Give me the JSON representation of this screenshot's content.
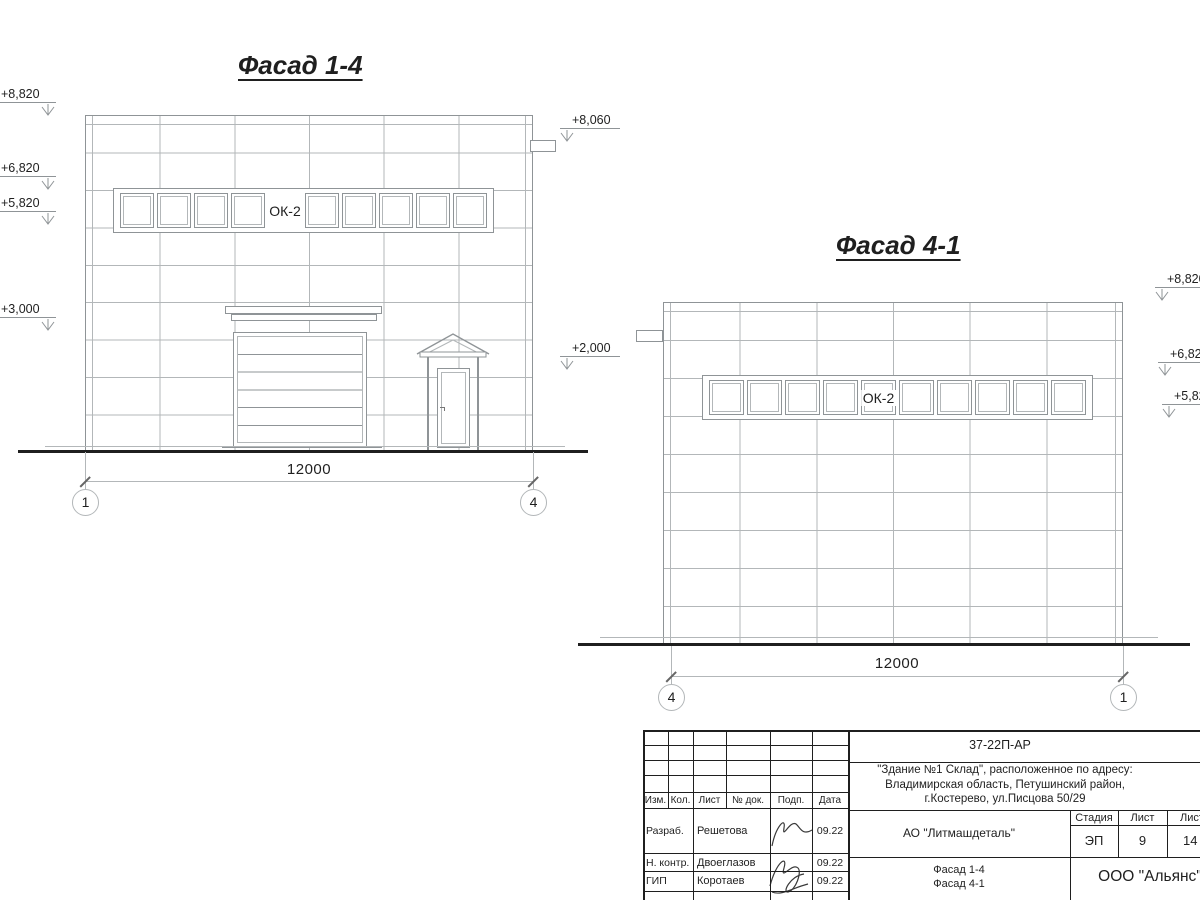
{
  "colors": {
    "grid_line": "#b3b7b9",
    "outline": "#8f9497",
    "ink": "#1f1f1f"
  },
  "facade14": {
    "title": "Фасад 1-4",
    "window_label": "ОК-2",
    "windows_count": 10,
    "label_cell": 5,
    "label_cell_framed": false,
    "dimension": "12000",
    "axis_left": "1",
    "axis_right": "4",
    "elevations_left": [
      {
        "label": "+8,820"
      },
      {
        "label": "+6,820"
      },
      {
        "label": "+5,820"
      },
      {
        "label": "+3,000"
      }
    ],
    "elevations_right": [
      {
        "label": "+8,060"
      },
      {
        "label": "+2,000"
      }
    ]
  },
  "facade41": {
    "title": "Фасад 4-1",
    "window_label": "ОК-2",
    "windows_count": 10,
    "label_cell": 5,
    "label_cell_framed": true,
    "dimension": "12000",
    "axis_left": "4",
    "axis_right": "1",
    "elevations_right": [
      {
        "label": "+8,820"
      },
      {
        "label": "+6,820"
      },
      {
        "label": "+5,820"
      }
    ]
  },
  "titleblock": {
    "doc_number": "37-22П-АР",
    "object_address": {
      "line1": "\"Здание №1 Склад\", расположенное по адресу:",
      "line2": "Владимирская область, Петушинский район,",
      "line3": "г.Костерево, ул.Писцова 50/29"
    },
    "columns": {
      "izm": "Изм.",
      "kol": "Кол.",
      "list": "Лист",
      "dok": "№ док.",
      "podp": "Подп.",
      "data": "Дата"
    },
    "staff": [
      {
        "role": "Разраб.",
        "name": "Решетова",
        "date": "09.22"
      },
      {
        "role": "Н. контр.",
        "name": "Двоеглазов",
        "date": "09.22"
      },
      {
        "role": "ГИП",
        "name": "Коротаев",
        "date": "09.22"
      }
    ],
    "customer": "АО \"Литмашдеталь\"",
    "stage": {
      "label": "Стадия",
      "value": "ЭП"
    },
    "sheet": {
      "label": "Лист",
      "value": "9"
    },
    "sheets": {
      "label": "Листов",
      "value": "14"
    },
    "content": {
      "line1": "Фасад 1-4",
      "line2": "Фасад 4-1"
    },
    "organization": "ООО \"Альянс\""
  }
}
